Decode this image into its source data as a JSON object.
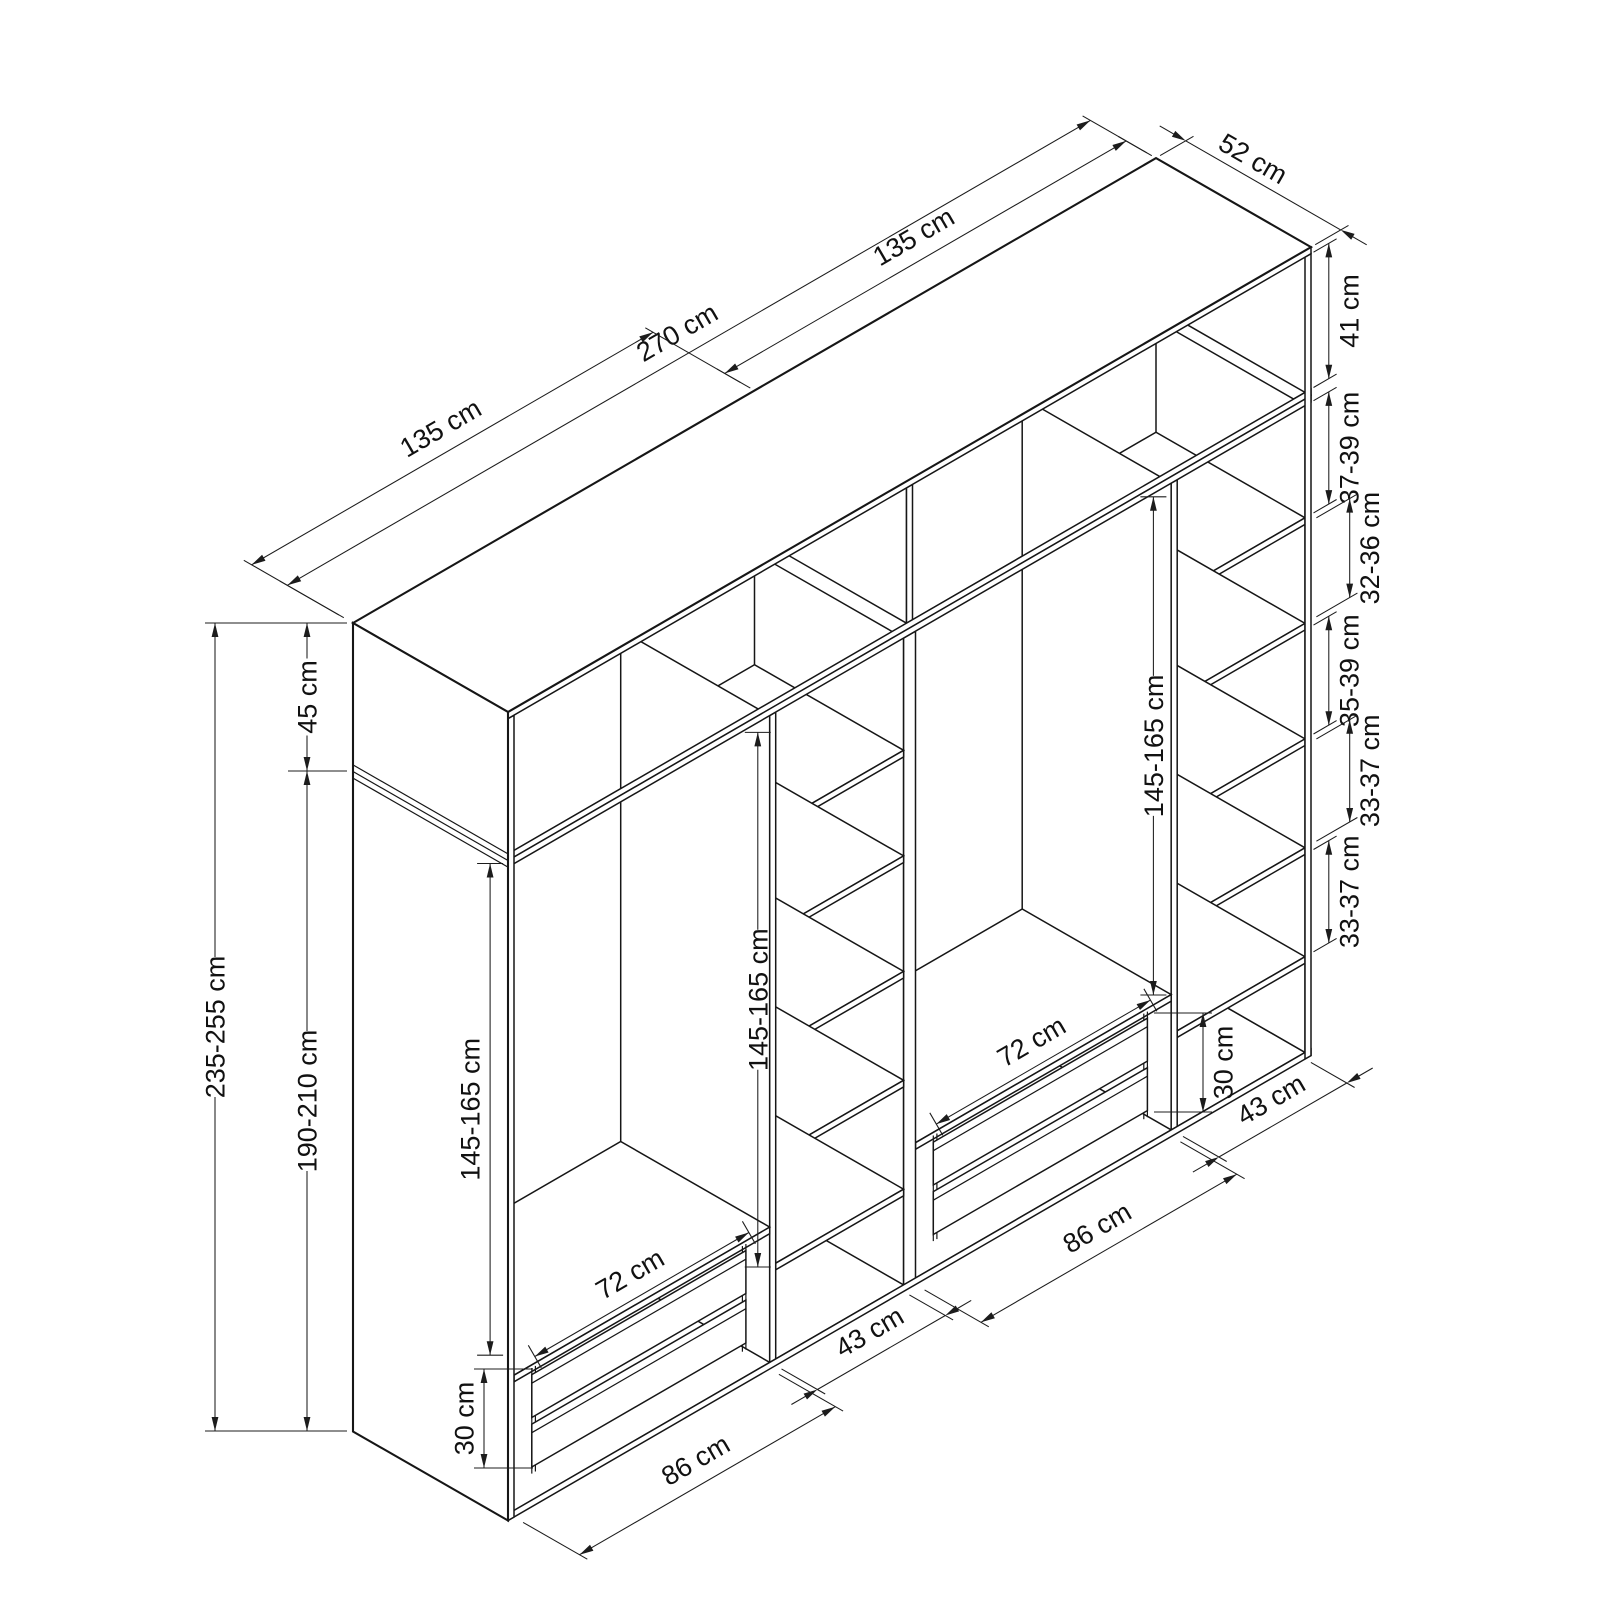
{
  "diagram": {
    "type": "wardrobe-dimension-drawing",
    "background": "#ffffff",
    "line_color": "#161616"
  },
  "dims": {
    "width_left_module": "135 cm",
    "width_total": "270 cm",
    "width_right_module": "135 cm",
    "depth": "52 cm",
    "top_interior_height": "41 cm",
    "shelf_gap_1": "37-39 cm",
    "shelf_gap_2": "32-36 cm",
    "shelf_gap_3": "35-39 cm",
    "shelf_gap_4": "33-37 cm",
    "shelf_gap_5": "33-37 cm",
    "height_total": "235-255 cm",
    "top_section_height": "45 cm",
    "body_height": "190-210 cm",
    "hanging_height_left": "145-165 cm",
    "hanging_height_middle": "145-165 cm",
    "hanging_height_right": "145-165 cm",
    "drawer_width_left": "72 cm",
    "drawer_width_right": "72 cm",
    "drawer_stack_height_left": "30 cm",
    "drawer_stack_height_right": "30 cm",
    "opening_width_left": "86 cm",
    "opening_width_right": "86 cm",
    "shelf_col_width_left": "43 cm",
    "shelf_col_width_right": "43 cm"
  }
}
